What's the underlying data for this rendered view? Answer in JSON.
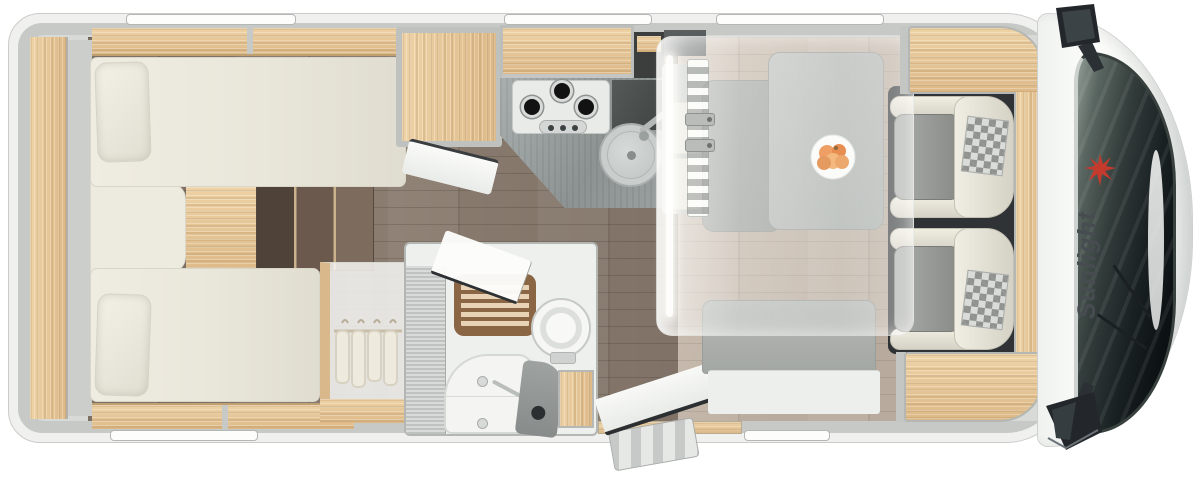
{
  "vehicle": {
    "brand_logo_text": "Sunlight"
  },
  "palette": {
    "background": "#ffffff",
    "body_wall": "#c6c9c6",
    "body_exterior_band": "#f0f1ef",
    "wood_light_oak": "#e8cb9c",
    "floor_dark_wood": "#84766a",
    "floor_dinette_wood": "#c6b9ab",
    "mattress_cream": "#ece9df",
    "kitchen_counter_gray": "#9aa09f",
    "steps_dark_wood": "#5f5044",
    "teak_shower_mat": "#8a6644",
    "windshield_dark": "#12171a",
    "cab_body_white": "#fbfcfa",
    "logo_red": "#c43a2c",
    "logo_text_color": "#474c50",
    "dropdown_bed_overlay": "rgba(250,250,248,0.45)"
  },
  "icons": {
    "sun-logo-icon": "red spiky sunburst (brand mark)",
    "hanger-icon": "clothes hanger in wardrobe",
    "side-mirror-top-icon": "exterior side mirror (top)",
    "side-mirror-bottom-icon": "exterior side mirror (bottom)",
    "gas-burner-icon": "hob burner ring",
    "sink-icon": "round kitchen sink with tap",
    "toilet-icon": "round cassette toilet",
    "fruit-plate-icon": "plate with fruit on dinette table"
  }
}
